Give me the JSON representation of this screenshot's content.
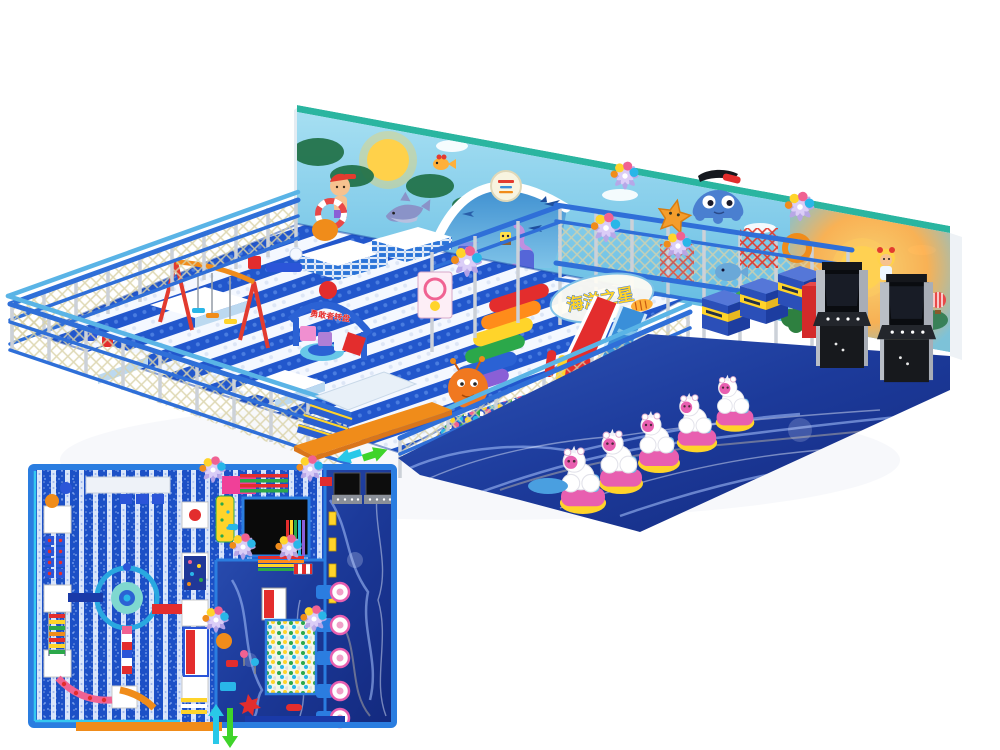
{
  "palette": {
    "bg": "#ffffff",
    "wall_sky_top": "#a6dff2",
    "wall_sky": "#58b5e0",
    "wall_edge_teal": "#2ab5a0",
    "sun_yellow": "#ffd24a",
    "floor_blue": "#2257cc",
    "floor_white": "#f4f8ff",
    "rail_blue": "#2f6fd8",
    "rail_light": "#5ab4e6",
    "post_gray": "#ccd1d8",
    "net_khaki": "#d9d2a8",
    "water_deep": "#13297e",
    "water_mid": "#2e54b8",
    "water_streak": "#aac4ff",
    "slide_red": "#e32d2d",
    "slide_blue": "#3a8fd9",
    "accent_orange": "#f08c1a",
    "accent_yellow": "#ffd42a",
    "accent_green": "#2ba84a",
    "accent_purple": "#8a5fd6",
    "accent_pink": "#f06292",
    "ride_pink": "#e85fb0",
    "arcade_dark": "#1d1f24",
    "arcade_gray": "#b9bec6",
    "pinwheel_lavender": "#b9a6e8",
    "octopus_blue": "#4a7fd0",
    "starfish_orange": "#f49d2c",
    "plan_border": "#2a7de0",
    "plan_stripe_blue": "#1c50c6",
    "plan_stripe_light": "#d8e4fa",
    "arrow_cyan": "#29c8e8",
    "arrow_green": "#3fd42a"
  },
  "signs": {
    "ocean_star": "海洋之星",
    "brave_wheel": "勇敢者转盘"
  },
  "view_3d": {
    "back_wall_mural": [
      "boy-swimmer",
      "sun",
      "palm-trees",
      "dolphin",
      "goldfish",
      "clouds"
    ],
    "dome_mural": [
      "logo-badge",
      "spongebob",
      "seahorse",
      "starfish",
      "sharks"
    ],
    "right_wall_mural": [
      "sunset-sun",
      "trees",
      "girl",
      "hot-air-balloon"
    ],
    "equipment": [
      "net-fence",
      "striped-padded-floor",
      "swing-set",
      "trampoline-mats",
      "brave-wheel-arch-sign",
      "rainbow-climb-steps",
      "ball-character-toy",
      "ocean-star-sign",
      "red-slide",
      "blue-wave-slide",
      "ball-pool",
      "two-level-play-structure",
      "octopus-cutout",
      "starfish-cutout",
      "pinwheels",
      "prize-machines",
      "foliage",
      "roller-barriers",
      "entrance-stairs",
      "entrance-platform",
      "direction-arrows",
      "water-floor"
    ],
    "kiddie_ride_count": 5,
    "arcade_machine_count": 2,
    "pinwheel_count": 5,
    "prize_machine_count": 3
  },
  "floor_plan": {
    "zones": [
      "striped-play-floor",
      "water-corridor",
      "ball-pool",
      "black-pad",
      "carousel",
      "trampoline-mats",
      "ladders",
      "rainbow-strips",
      "kiddie-rides",
      "arcade-machines",
      "entrance"
    ],
    "kiddie_ride_count": 5,
    "arcade_machine_count": 2,
    "pinwheel_count": 6,
    "mat_count": 9
  }
}
